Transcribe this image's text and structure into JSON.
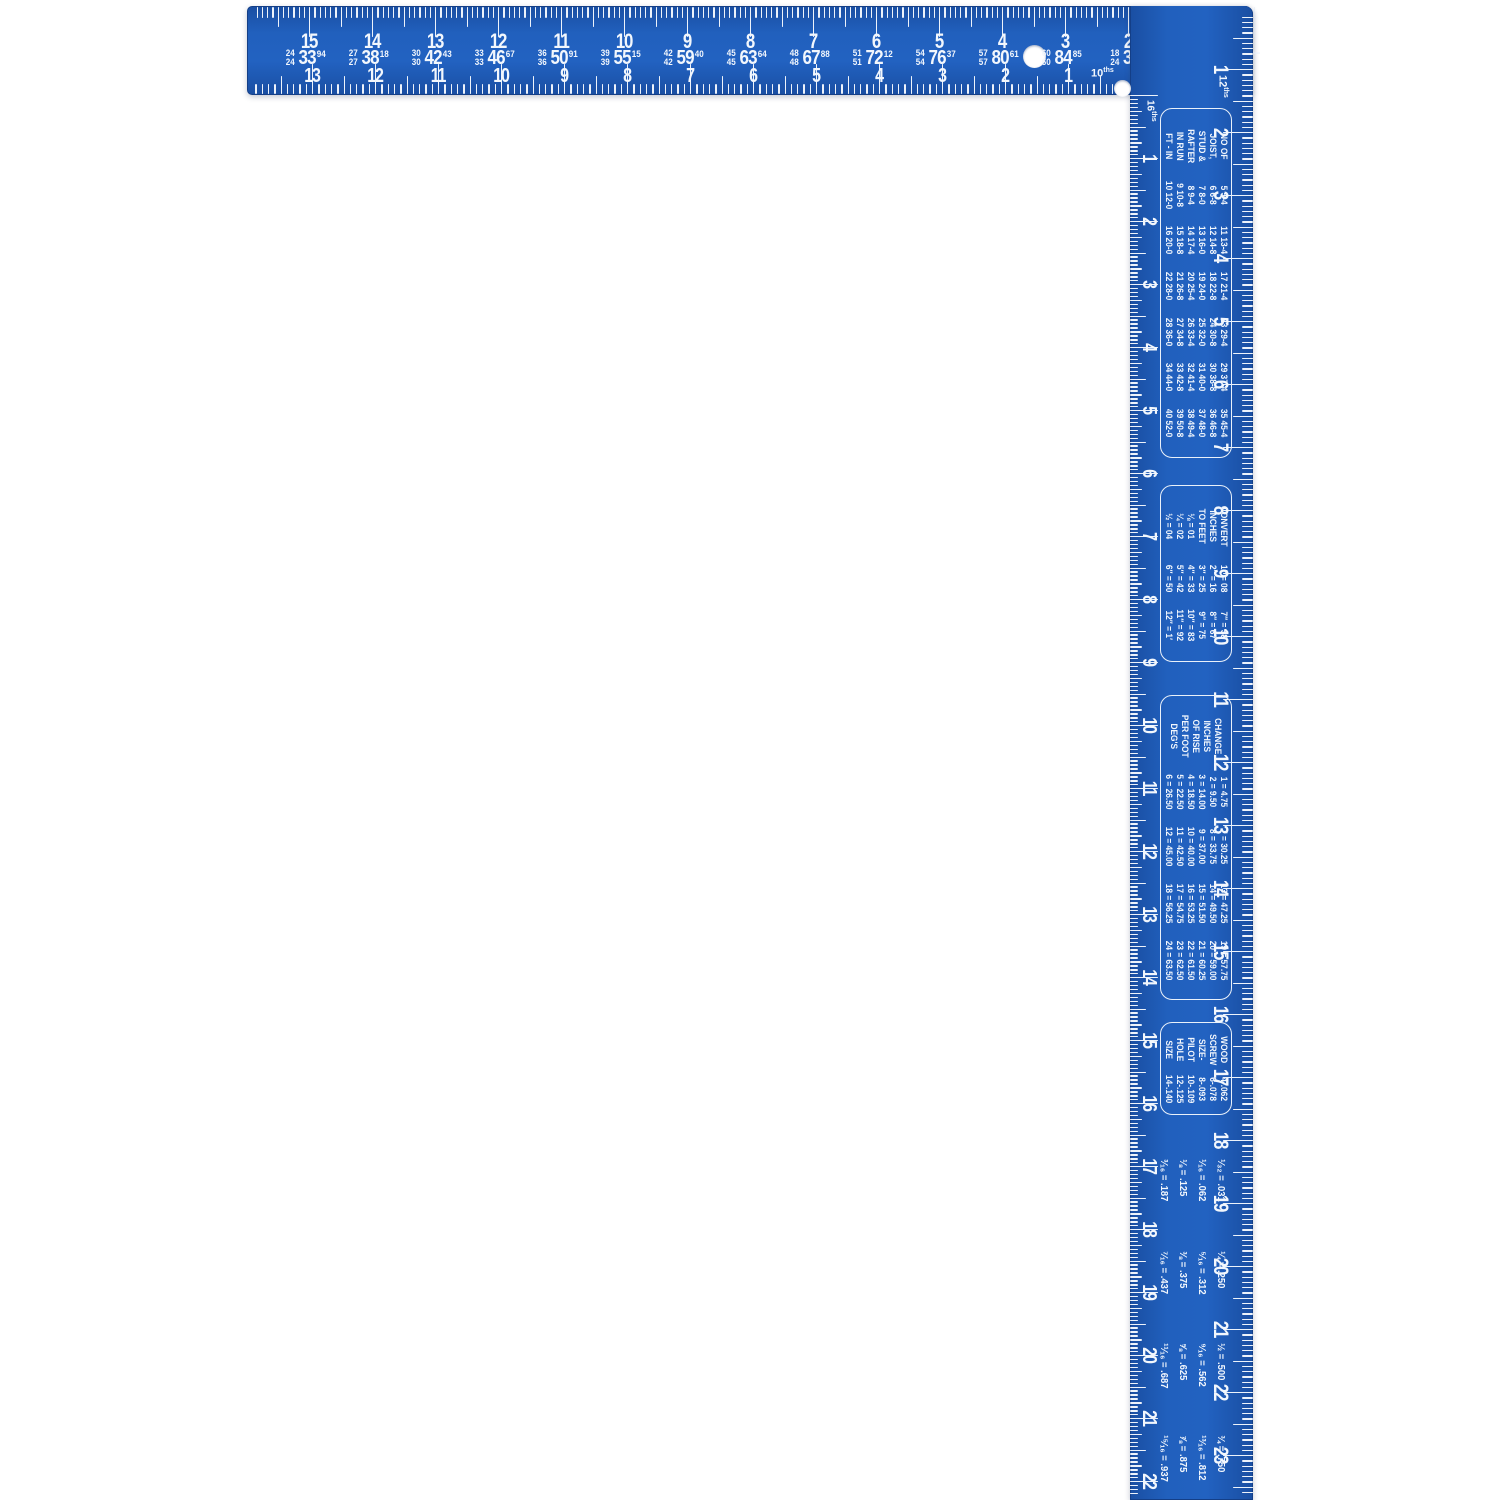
{
  "product": {
    "type": "framing-square",
    "logo_letter": "e",
    "registered_symbol": "®"
  },
  "colors": {
    "body_blue": "#2160bd",
    "edge_blue": "#143f87",
    "markings_white": "#f2f7fd",
    "background": "#ffffff"
  },
  "tongue": {
    "outer_scale": {
      "label_num": "12",
      "label_sup": "ths",
      "divisions_per_inch": 12,
      "numbers": [
        1,
        2,
        3,
        4,
        5,
        6,
        7,
        8,
        9,
        10,
        11,
        12,
        13,
        14,
        15
      ]
    },
    "inner_scale": {
      "label_num": "10",
      "label_sup": "ths",
      "divisions_per_inch": 10,
      "numbers": [
        1,
        2,
        3,
        4,
        5,
        6,
        7,
        8,
        9,
        10,
        11,
        12,
        13
      ]
    },
    "brace_table": [
      {
        "top": "24",
        "bottom": "24",
        "value": "33",
        "sup": "94",
        "inch": 15
      },
      {
        "top": "27",
        "bottom": "27",
        "value": "38",
        "sup": "18",
        "inch": 14
      },
      {
        "top": "30",
        "bottom": "30",
        "value": "42",
        "sup": "43",
        "inch": 13
      },
      {
        "top": "33",
        "bottom": "33",
        "value": "46",
        "sup": "67",
        "inch": 12
      },
      {
        "top": "36",
        "bottom": "36",
        "value": "50",
        "sup": "91",
        "inch": 11
      },
      {
        "top": "39",
        "bottom": "39",
        "value": "55",
        "sup": "15",
        "inch": 10
      },
      {
        "top": "42",
        "bottom": "42",
        "value": "59",
        "sup": "40",
        "inch": 9
      },
      {
        "top": "45",
        "bottom": "45",
        "value": "63",
        "sup": "64",
        "inch": 8
      },
      {
        "top": "48",
        "bottom": "48",
        "value": "67",
        "sup": "88",
        "inch": 7
      },
      {
        "top": "51",
        "bottom": "51",
        "value": "72",
        "sup": "12",
        "inch": 6
      },
      {
        "top": "54",
        "bottom": "54",
        "value": "76",
        "sup": "37",
        "inch": 5
      },
      {
        "top": "57",
        "bottom": "57",
        "value": "80",
        "sup": "61",
        "inch": 4
      },
      {
        "top": "60",
        "bottom": "60",
        "value": "84",
        "sup": "85",
        "inch": 3
      },
      {
        "top": "18",
        "bottom": "24",
        "value": "30",
        "sup": "",
        "inch": 2
      }
    ]
  },
  "body": {
    "outer_scale": {
      "label_num": "12",
      "label_sup": "ths",
      "divisions_per_inch": 12,
      "numbers": [
        1,
        2,
        3,
        4,
        5,
        6,
        7,
        8,
        9,
        10,
        11,
        12,
        13,
        14,
        15,
        16,
        17,
        18,
        19,
        20,
        21,
        22,
        23
      ]
    },
    "inner_scale": {
      "label_num": "16",
      "label_sup": "ths",
      "divisions_per_inch": 16,
      "numbers": [
        1,
        2,
        3,
        4,
        5,
        6,
        7,
        8,
        9,
        10,
        11,
        12,
        13,
        14,
        15,
        16,
        17,
        18,
        19,
        20,
        21,
        22
      ]
    },
    "tables": {
      "joist": {
        "header": [
          "NO OF",
          "JOIST,",
          "STUD &",
          "RAFTER",
          "IN RUN",
          "FT - IN"
        ],
        "columns": [
          [
            "5 5-4",
            "6 6-8",
            "7 8-0",
            "8 9-4",
            "9 10-8",
            "10 12-0"
          ],
          [
            "11 13-4",
            "12 14-8",
            "13 16-0",
            "14 17-4",
            "15 18-8",
            "16 20-0"
          ],
          [
            "17 21-4",
            "18 22-8",
            "19 24-0",
            "20 25-4",
            "21 26-8",
            "22 28-0"
          ],
          [
            "23 29-4",
            "24 30-8",
            "25 32-0",
            "26 33-4",
            "27 34-8",
            "28 36-0"
          ],
          [
            "29 37-4",
            "30 38-8",
            "31 40-0",
            "32 41-4",
            "33 42-8",
            "34 44-0"
          ],
          [
            "35 45-4",
            "36 46-8",
            "37 48-0",
            "38 49-4",
            "39 50-8",
            "40 52-0"
          ]
        ]
      },
      "convert": {
        "header": [
          "CONVERT",
          "INCHES",
          "TO FEET"
        ],
        "fractions": [
          "⅛ = 01",
          "¼ = 02",
          "½ = 04"
        ],
        "columns": [
          [
            "1″ = 08",
            "2″ = 16",
            "3″ = 25",
            "4″ = 33",
            "5″ = 42",
            "6″ = 50"
          ],
          [
            "7″ = 58",
            "8″ = 67",
            "9″ = 75",
            "10″ = 83",
            "11″ = 92",
            "12″ = 1′"
          ]
        ]
      },
      "rise": {
        "header": [
          "CHANGE",
          "INCHES",
          "OF RISE",
          "PER FOOT",
          "DEG'S"
        ],
        "columns": [
          [
            "1 = 4.75",
            "2 = 9.50",
            "3 = 14.00",
            "4 = 18.50",
            "5 = 22.50",
            "6 = 26.50"
          ],
          [
            "7 = 30.25",
            "8 = 33.75",
            "9 = 37.00",
            "10 = 40.00",
            "11 = 42.50",
            "12 = 45.00"
          ],
          [
            "13 = 47.25",
            "14 = 49.50",
            "15 = 51.50",
            "16 = 53.25",
            "17 = 54.75",
            "18 = 56.25"
          ],
          [
            "19 = 57.75",
            "20 = 59.00",
            "21 = 60.25",
            "22 = 61.50",
            "23 = 62.50",
            "24 = 63.50"
          ]
        ]
      },
      "screw": {
        "header": [
          "WOOD",
          "SCREW",
          "SIZE-",
          "PILOT",
          "HOLE",
          "SIZE"
        ],
        "values": [
          "4-.062",
          "6-.078",
          "8-.093",
          "10-.109",
          "12-.125",
          "14-.140"
        ]
      },
      "decimals": {
        "groups": [
          [
            "¹⁄₃₂ = .031",
            "¹⁄₁₆ = .062",
            "⅛ = .125",
            "³⁄₁₆ = .187"
          ],
          [
            "¼ = .250",
            "⁵⁄₁₆ = .312",
            "⅜ = .375",
            "⁷⁄₁₆ = .437"
          ],
          [
            "½ = .500",
            "⁹⁄₁₆ = .562",
            "⅝ = .625",
            "¹¹⁄₁₆ = .687"
          ],
          [
            "¾ = .750",
            "¹³⁄₁₆ = .812",
            "⅞ = .875",
            "¹⁵⁄₁₆ = .937"
          ]
        ]
      }
    }
  }
}
